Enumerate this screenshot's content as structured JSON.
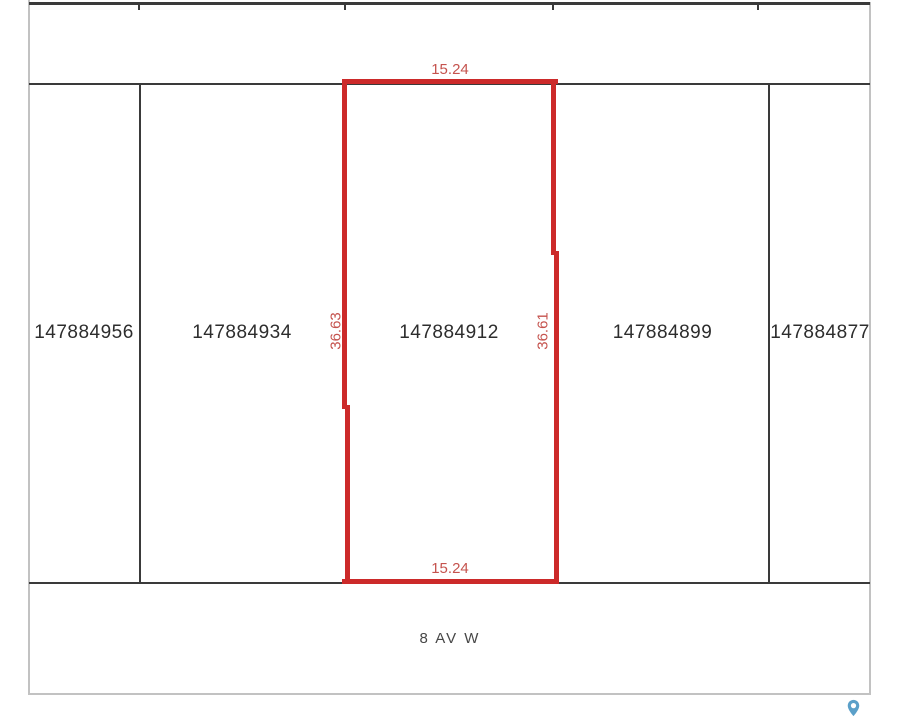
{
  "map": {
    "street": {
      "label": "8 AV W"
    },
    "parcels": [
      {
        "id": "147884956",
        "selected": false
      },
      {
        "id": "147884934",
        "selected": false
      },
      {
        "id": "147884912",
        "selected": true
      },
      {
        "id": "147884899",
        "selected": false
      },
      {
        "id": "147884877",
        "selected": false
      }
    ],
    "selected_parcel": {
      "id": "147884912",
      "dimensions": {
        "top": "15.24",
        "bottom": "15.24",
        "left": "36.63",
        "right": "36.61"
      }
    }
  },
  "icons": {
    "pin": "map-pin-icon"
  },
  "colors": {
    "highlight": "#cc2a2a",
    "dimension_text": "#c5534e",
    "parcel_line": "#3a3a3a",
    "frame_border": "#c2c2c2",
    "parcel_text": "#2d2d2d",
    "street_text": "#474747",
    "pin": "#5ba0c9"
  }
}
